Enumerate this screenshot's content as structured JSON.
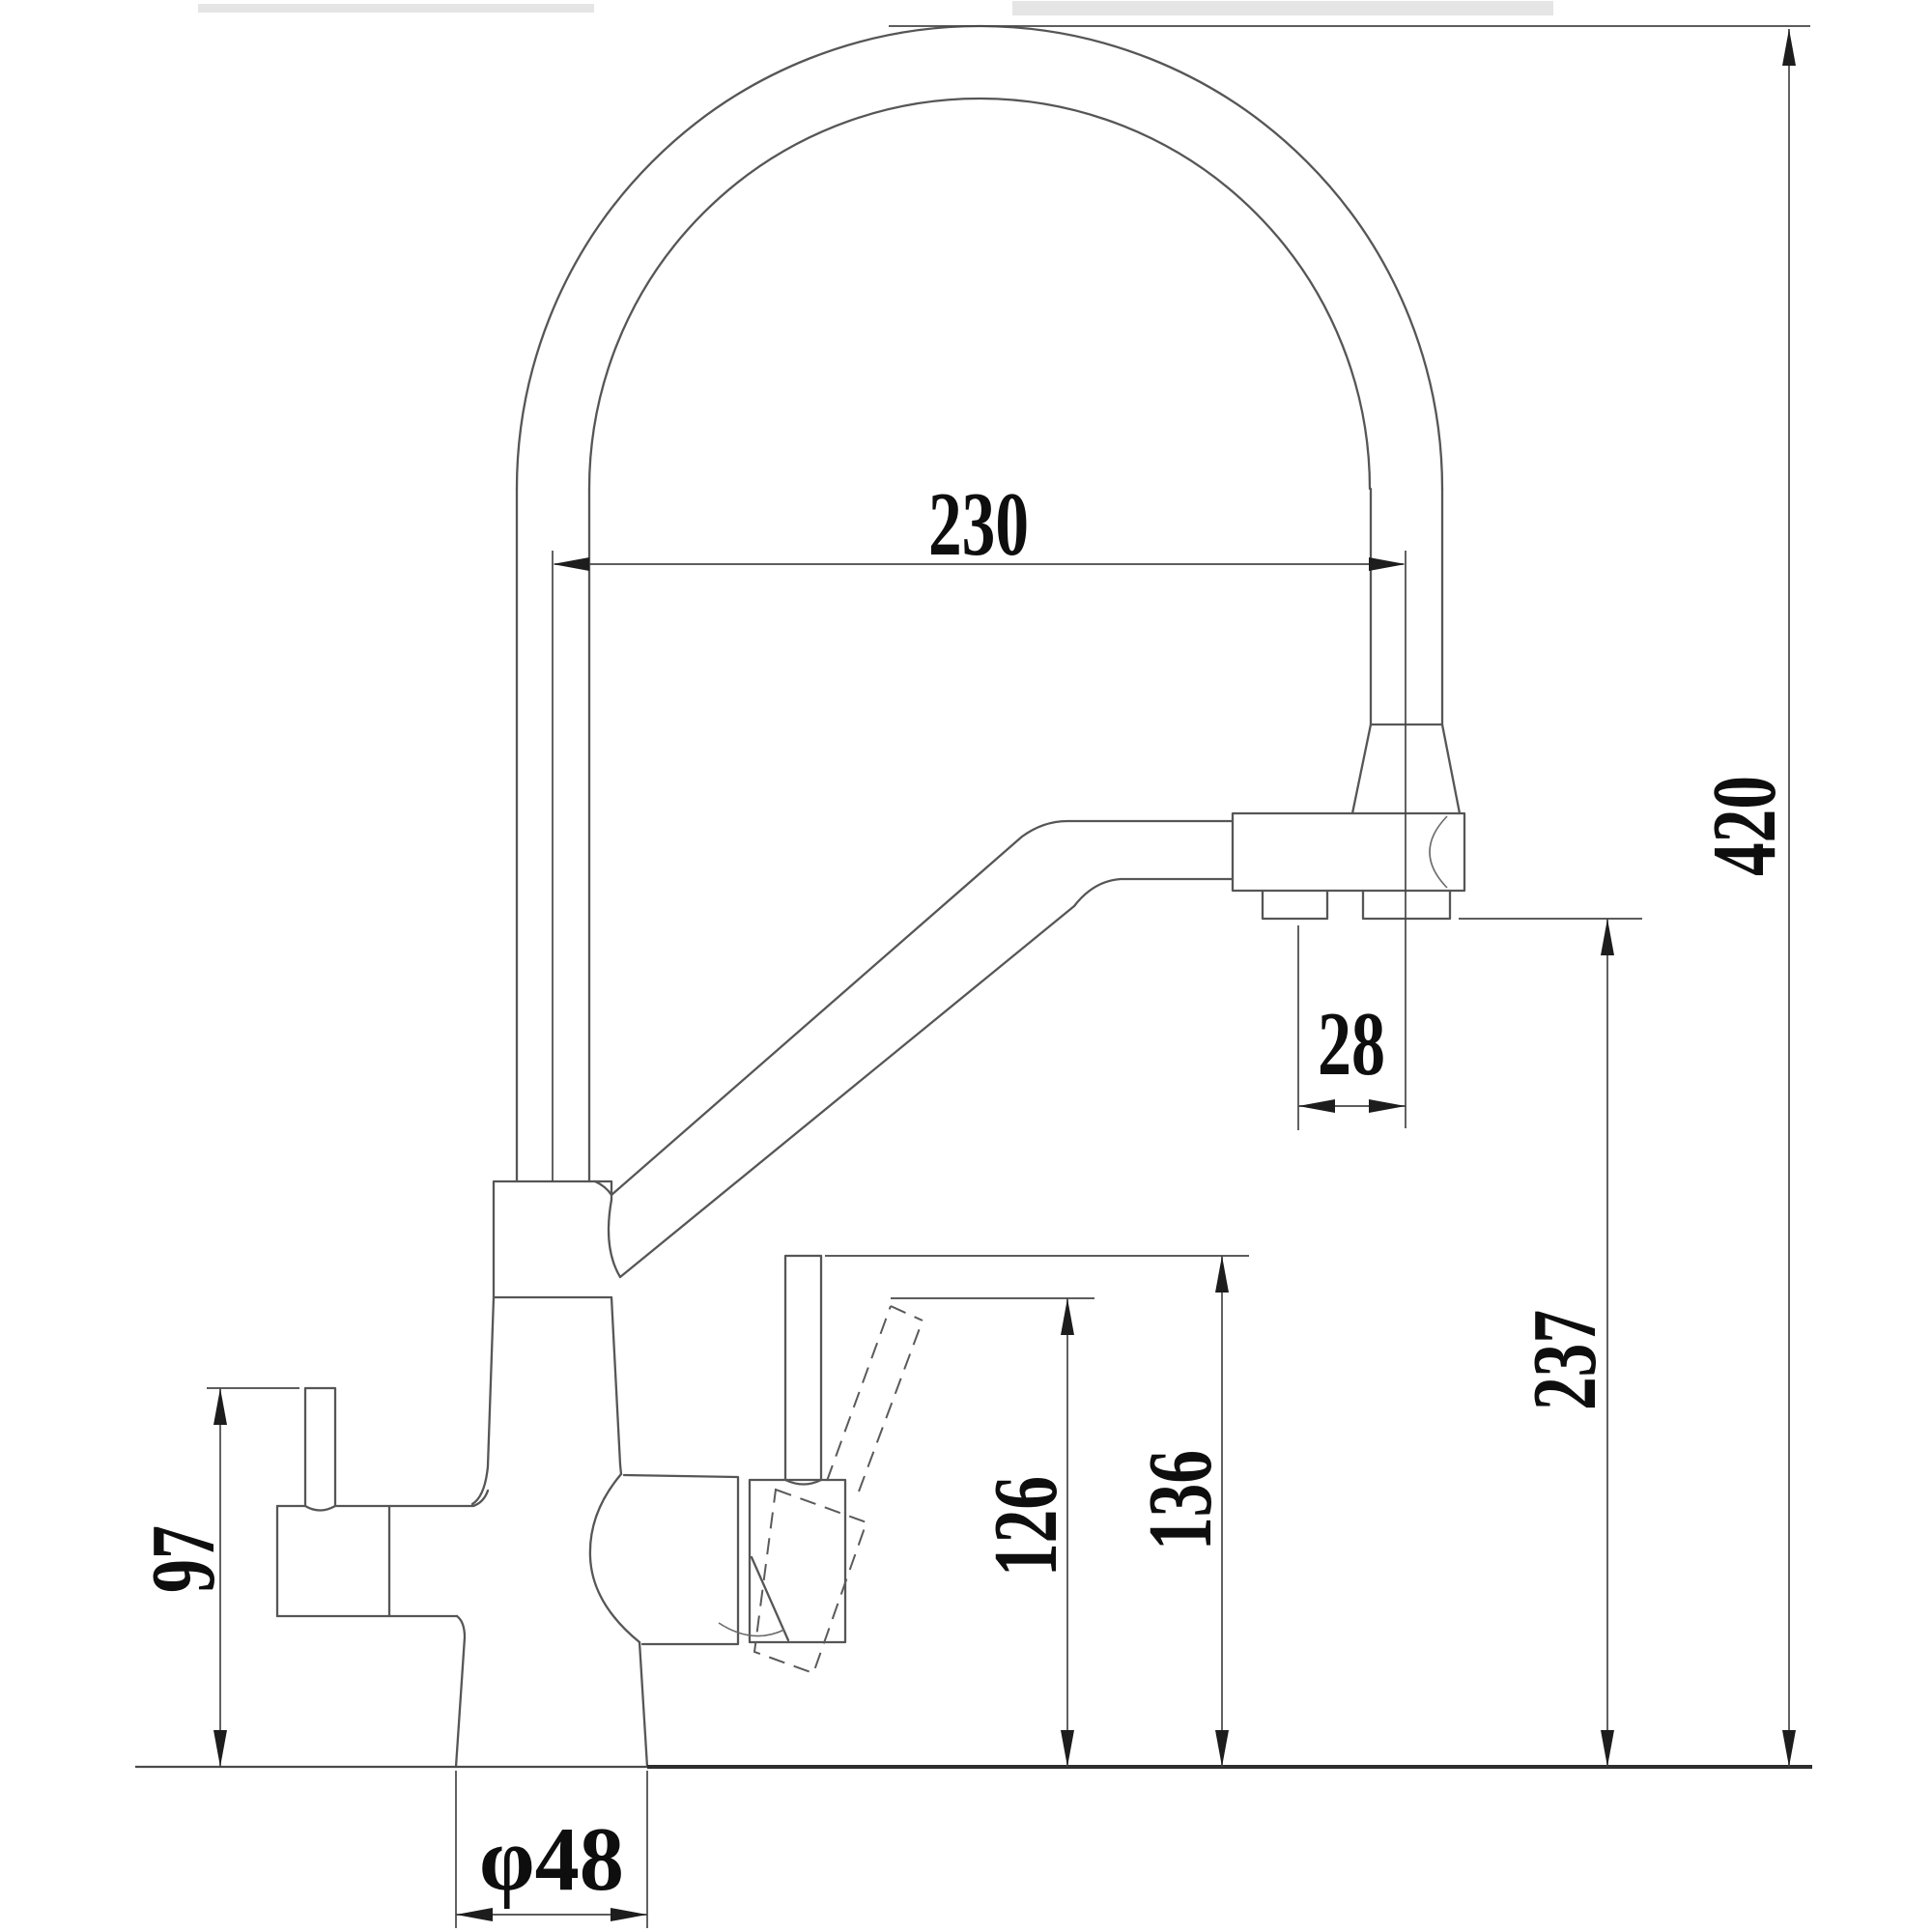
{
  "drawing": {
    "background": "#ffffff",
    "line_color": "#565656",
    "dim_color": "#464646",
    "text_color": "#0e0e0e",
    "dims": {
      "reach": {
        "label": "230"
      },
      "overall_height": {
        "label": "420"
      },
      "nozzle_offset": {
        "label": "28"
      },
      "outlet_height": {
        "label": "237"
      },
      "handle_tilted_height": {
        "label": "126"
      },
      "handle_height": {
        "label": "136"
      },
      "side_spout_height": {
        "label": "97"
      },
      "base_diameter": {
        "label": "φ48"
      }
    }
  }
}
